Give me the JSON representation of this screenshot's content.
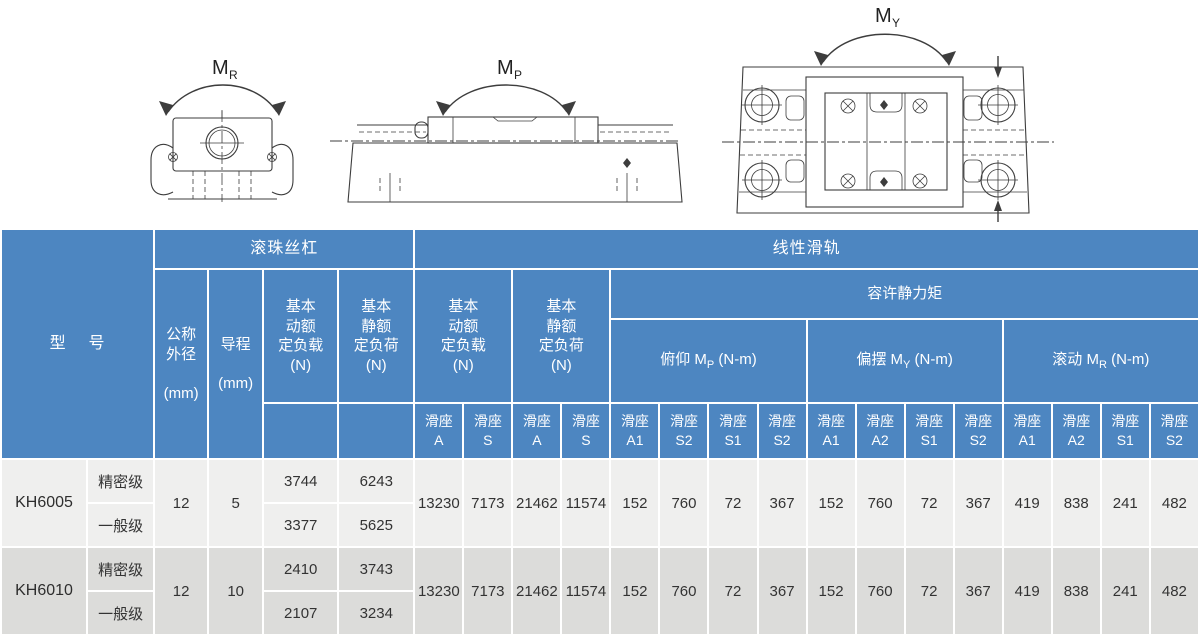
{
  "diagrams": {
    "roll": {
      "m": "M",
      "sub": "R"
    },
    "pitch": {
      "m": "M",
      "sub": "P"
    },
    "yaw": {
      "m": "M",
      "sub": "Y"
    }
  },
  "colors": {
    "header_blue": "#4d86c1",
    "row_light": "#efefee",
    "row_dark": "#dcdcda",
    "line_color": "#3d3d3d"
  },
  "table": {
    "header": {
      "model": "型    号",
      "ball_screw": "滚珠丝杠",
      "linear_rail": "线性滑轨",
      "nominal_od": "公称\n外径\n\n(mm)",
      "lead": "导程\n\n(mm)",
      "bs_dyn": "基本\n动额\n定负载\n(N)",
      "bs_stat": "基本\n静额\n定负荷\n(N)",
      "lg_dyn": "基本\n动额\n定负载\n(N)",
      "lg_stat": "基本\n静额\n定负荷\n(N)",
      "static_moment": "容许静力矩",
      "pitch": {
        "pre": "俯仰 M",
        "sub": "P",
        "post": " (N-m)"
      },
      "yaw": {
        "pre": "偏摆 M",
        "sub": "Y",
        "post": " (N-m)"
      },
      "roll": {
        "pre": "滚动 M",
        "sub": "R",
        "post": " (N-m)"
      },
      "seats": [
        "滑座\nA",
        "滑座\nS",
        "滑座\nA",
        "滑座\nS",
        "滑座\nA1",
        "滑座\nS2",
        "滑座\nS1",
        "滑座\nS2",
        "滑座\nA1",
        "滑座\nA2",
        "滑座\nS1",
        "滑座\nS2",
        "滑座\nA1",
        "滑座\nA2",
        "滑座\nS1",
        "滑座\nS2"
      ]
    },
    "rows": [
      {
        "model": "KH6005",
        "od": "12",
        "lead": "5",
        "grades": [
          {
            "grade": "精密级",
            "dyn": "3744",
            "stat": "6243"
          },
          {
            "grade": "一般级",
            "dyn": "3377",
            "stat": "5625"
          }
        ],
        "shared": [
          "13230",
          "7173",
          "21462",
          "11574",
          "152",
          "760",
          "72",
          "367",
          "152",
          "760",
          "72",
          "367",
          "419",
          "838",
          "241",
          "482"
        ]
      },
      {
        "model": "KH6010",
        "od": "12",
        "lead": "10",
        "grades": [
          {
            "grade": "精密级",
            "dyn": "2410",
            "stat": "3743"
          },
          {
            "grade": "一般级",
            "dyn": "2107",
            "stat": "3234"
          }
        ],
        "shared": [
          "13230",
          "7173",
          "21462",
          "11574",
          "152",
          "760",
          "72",
          "367",
          "152",
          "760",
          "72",
          "367",
          "419",
          "838",
          "241",
          "482"
        ]
      }
    ]
  }
}
